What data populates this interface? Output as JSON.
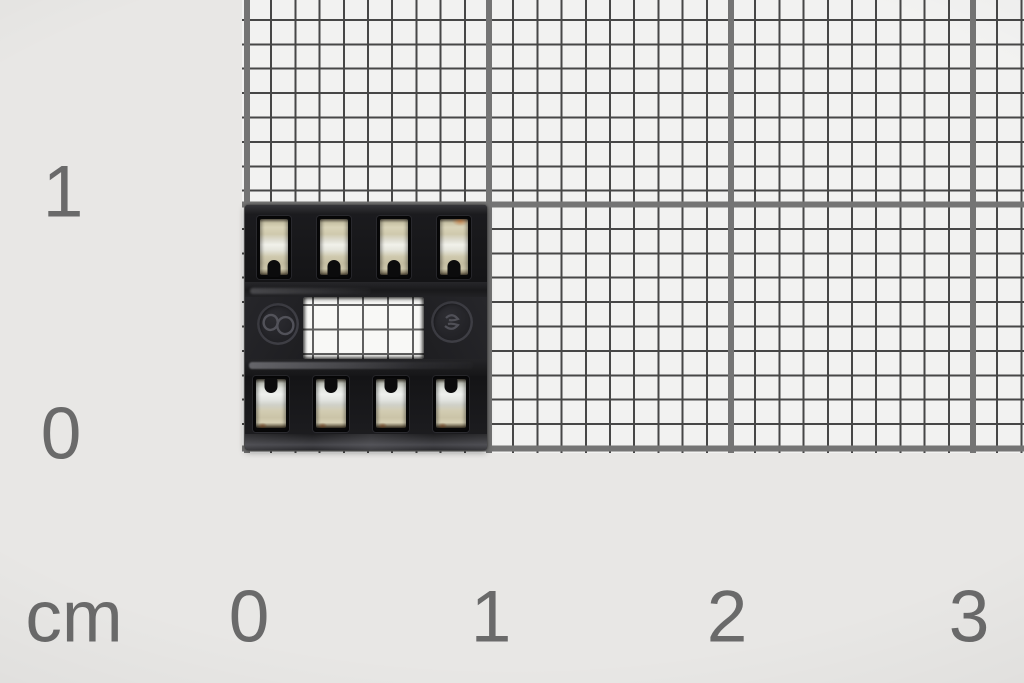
{
  "photo": {
    "subject": "8-pin DIP IC socket photographed on millimeter grid paper with centimeter scale"
  },
  "ruler": {
    "unit_label": "cm",
    "side_labels": [
      "1",
      "0"
    ],
    "bottom_labels": [
      "0",
      "1",
      "2",
      "3"
    ],
    "minor_division_mm": 1,
    "major_division_cm": 1
  },
  "icons": {
    "left_mold_mark": "figure-eight-mold-mark",
    "right_mold_mark": "manufacturer-logo-mold-mark"
  },
  "colors": {
    "margin_background": "#e8e7e5",
    "paper": "#f2f2f1",
    "thin_grid_line": "#474747",
    "thick_grid_line": "#747474",
    "label_text": "#6a6a6a",
    "socket_plastic": "#202023",
    "contact_beige": "#cfc9ad",
    "contact_silver": "#f1f1ea"
  }
}
